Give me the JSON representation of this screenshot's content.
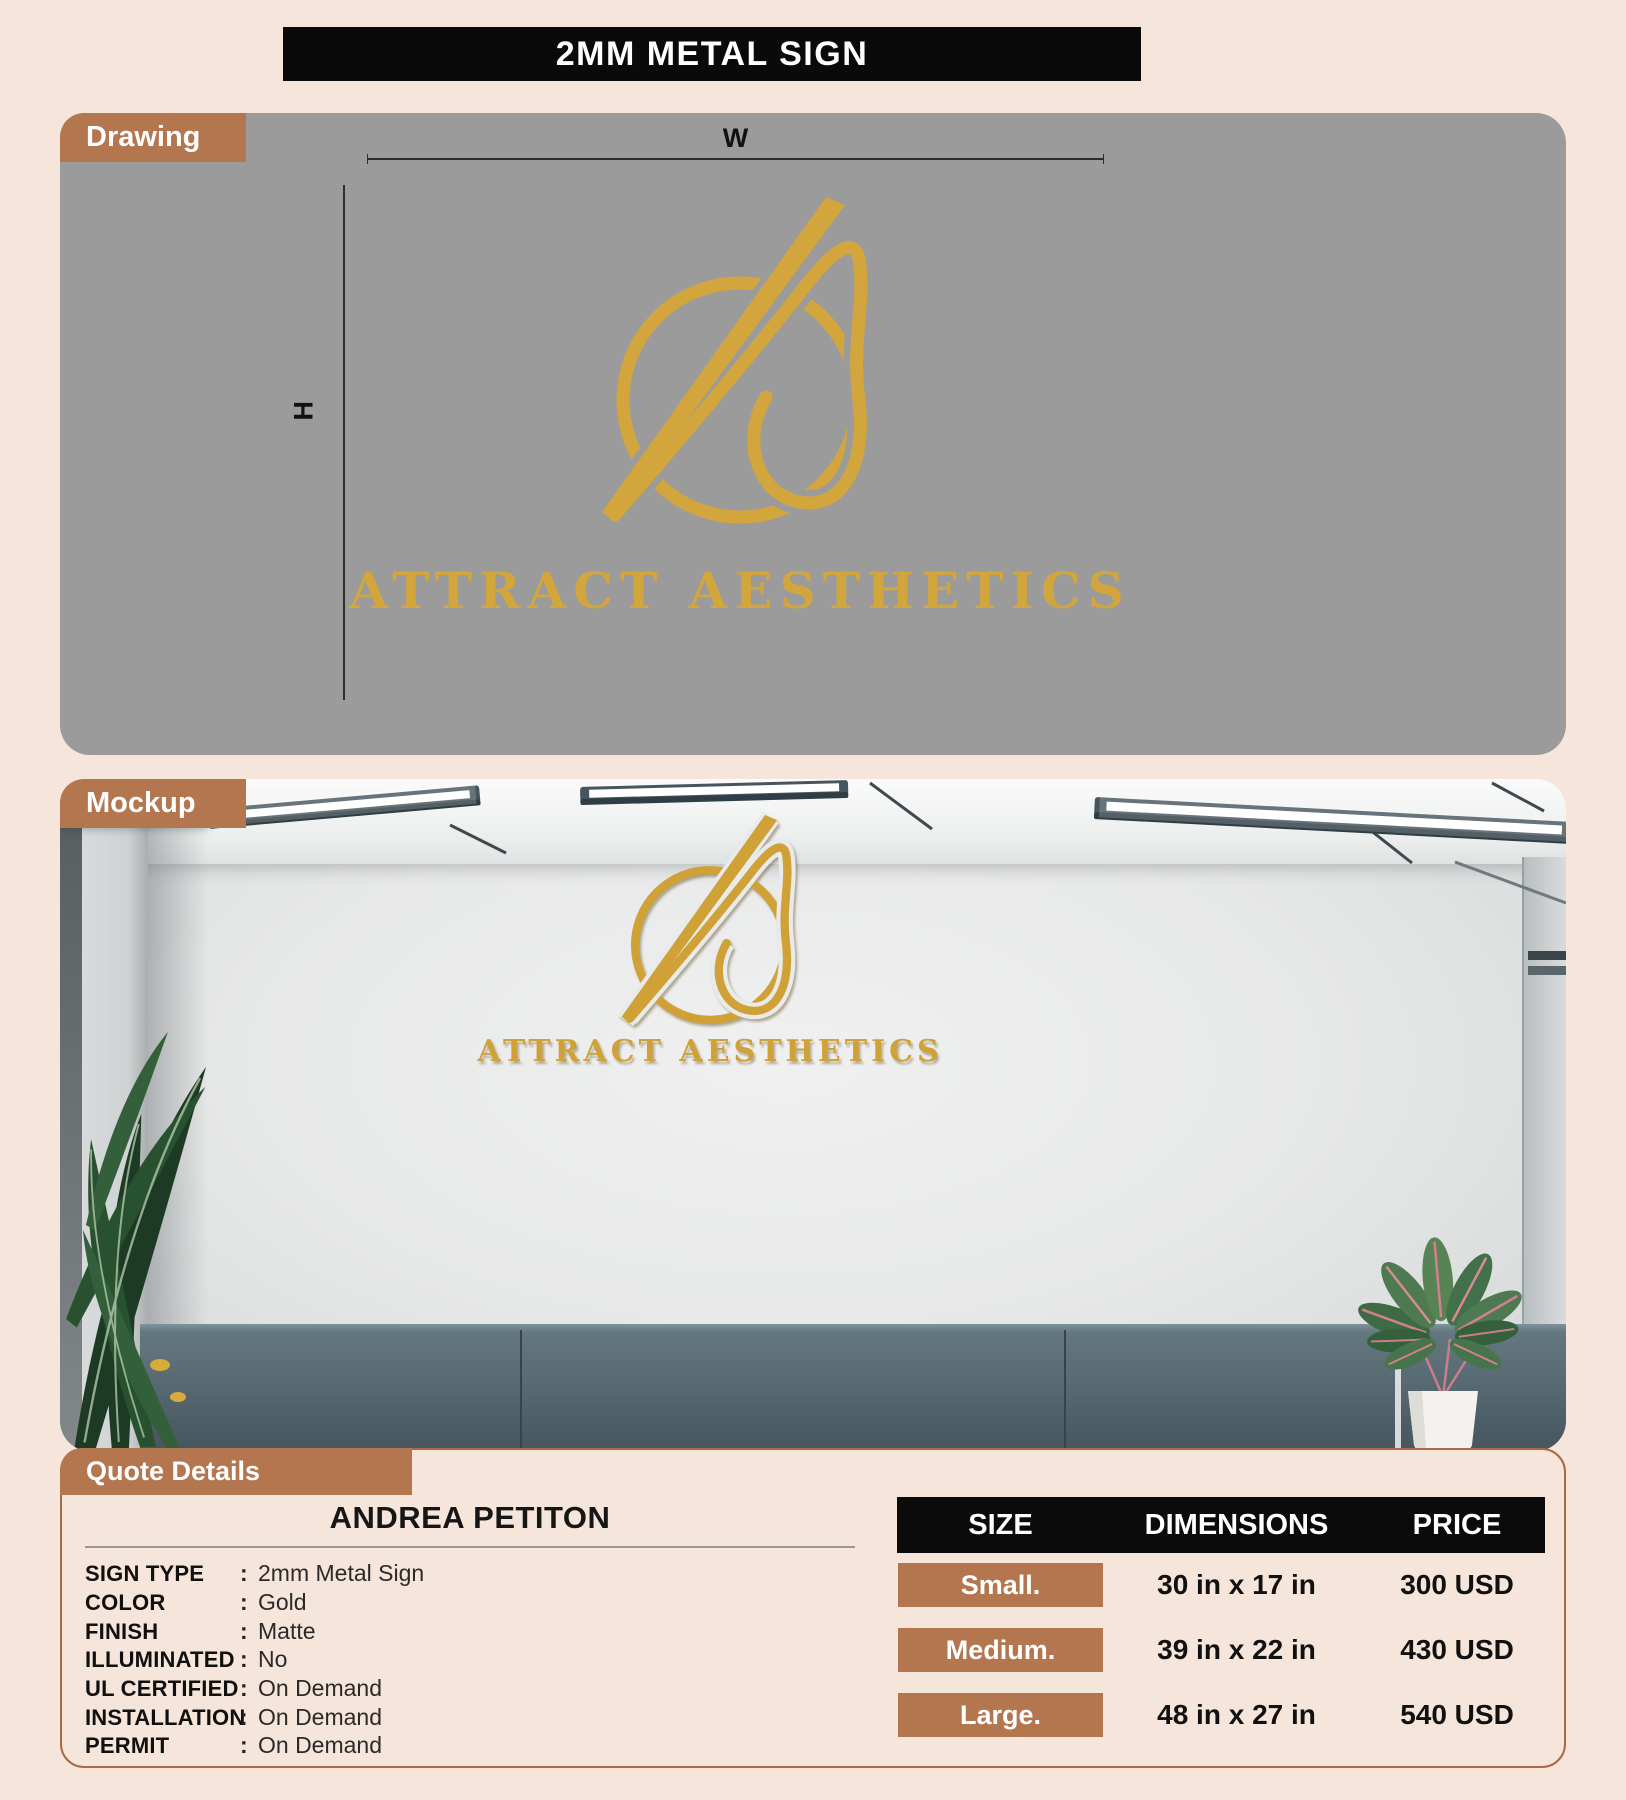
{
  "title": "2MM METAL SIGN",
  "drawing": {
    "tab": "Drawing",
    "width_label": "W",
    "height_label": "H",
    "logo_text": "ATTRACT AESTHETICS"
  },
  "mockup": {
    "tab": "Mockup",
    "logo_text": "ATTRACT AESTHETICS"
  },
  "quote": {
    "tab": "Quote Details",
    "customer_name": "ANDREA PETITON",
    "separator": ":",
    "details": [
      {
        "label": "SIGN TYPE",
        "value": "2mm Metal Sign"
      },
      {
        "label": "COLOR",
        "value": "Gold"
      },
      {
        "label": "FINISH",
        "value": "Matte"
      },
      {
        "label": "ILLUMINATED",
        "value": "No"
      },
      {
        "label": "UL CERTIFIED",
        "value": "On Demand"
      },
      {
        "label": "INSTALLATION",
        "value": "On Demand"
      },
      {
        "label": "PERMIT",
        "value": "On Demand"
      }
    ]
  },
  "pricing": {
    "headers": [
      "SIZE",
      "DIMENSIONS",
      "PRICE"
    ],
    "rows": [
      {
        "size": "Small.",
        "dimensions": "30 in x 17 in",
        "price": "300 USD"
      },
      {
        "size": "Medium.",
        "dimensions": "39 in x 22 in",
        "price": "430 USD"
      },
      {
        "size": "Large.",
        "dimensions": "48 in x 27 in",
        "price": "540 USD"
      }
    ]
  },
  "colors": {
    "page_bg": "#f6e5da",
    "accent_brown": "#b3764f",
    "gold": "#d2a63c",
    "header_black": "#0b0b0b",
    "drawing_gray": "#9b9b9b",
    "cabinet_teal": "#55666f"
  }
}
